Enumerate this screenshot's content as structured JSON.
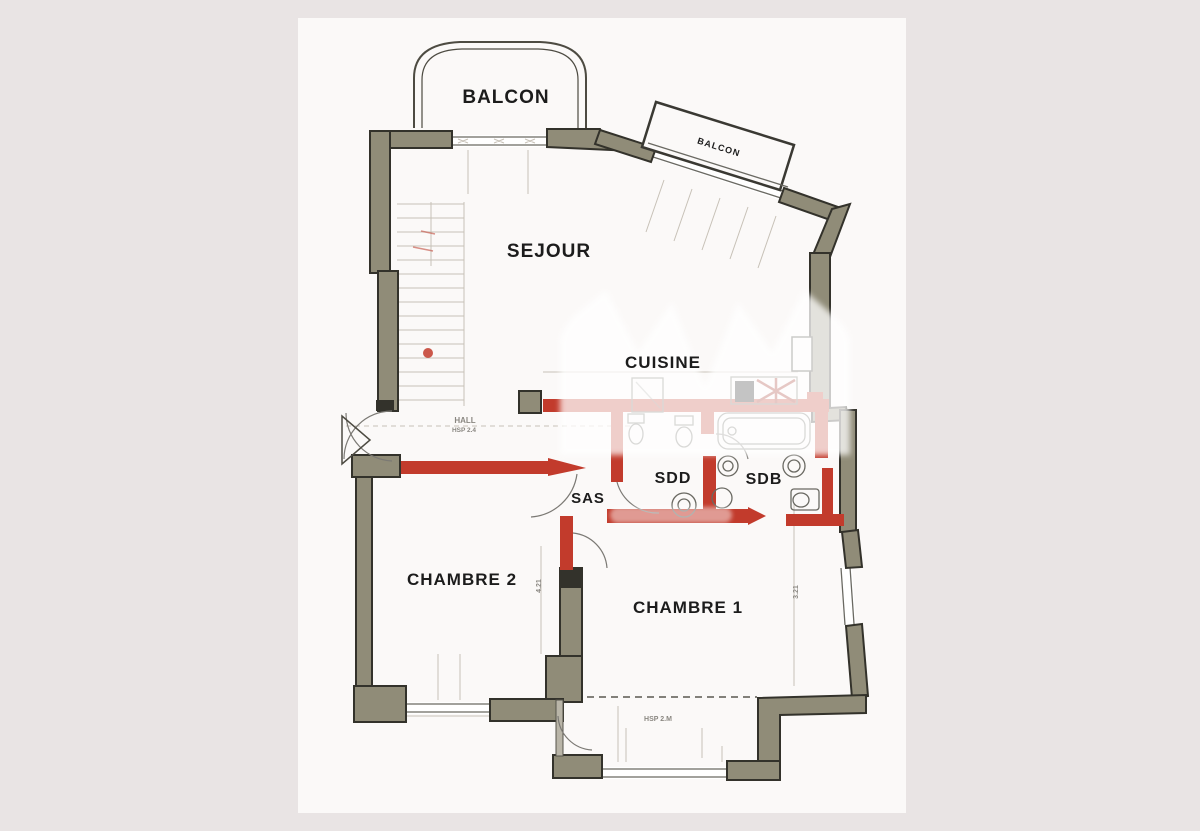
{
  "plan": {
    "labels": {
      "balcon_main": "BALCON",
      "balcon_small": "BALCON",
      "sejour": "SEJOUR",
      "cuisine": "CUISINE",
      "sdd": "SDD",
      "sdb": "SDB",
      "sas": "SAS",
      "hall": "HALL",
      "chambre2": "CHAMBRE 2",
      "chambre1": "CHAMBRE 1"
    },
    "annotations": {
      "hall_height": "HSP 2.4",
      "chambre1_height": "HSP 2.M",
      "dim_left": "4.21",
      "dim_right": "3.21"
    },
    "colors": {
      "background": "#e9e4e4",
      "paper": "#fbf9f8",
      "wall_fill": "#908c78",
      "wall_stroke": "#33322b",
      "line": "#6a6962",
      "faint": "#c7c1b7",
      "red": "#c23b2c",
      "red_dark": "#9e2318",
      "text": "#1c1c1c",
      "dim_text": "#8a8781"
    }
  }
}
